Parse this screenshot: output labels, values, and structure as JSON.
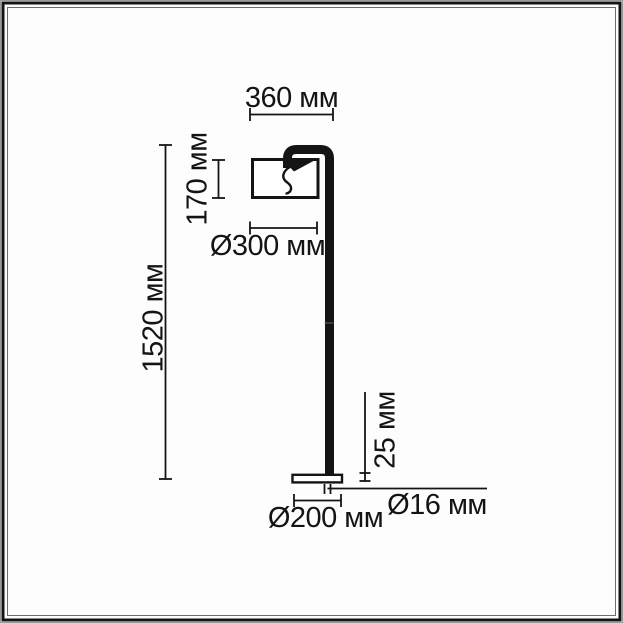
{
  "diagram": {
    "type": "technical-dimension-drawing",
    "subject": "floor-lamp",
    "units": "мм",
    "dimensions": {
      "arm_reach": {
        "label": "360 мм",
        "value": 360,
        "orientation": "horizontal"
      },
      "shade_height": {
        "label": "170 мм",
        "value": 170,
        "orientation": "vertical"
      },
      "shade_diameter": {
        "label": "Ø300 мм",
        "value": 300,
        "orientation": "horizontal"
      },
      "total_height": {
        "label": "1520 мм",
        "value": 1520,
        "orientation": "vertical"
      },
      "base_thickness": {
        "label": "25 мм",
        "value": 25,
        "orientation": "vertical"
      },
      "pole_diameter": {
        "label": "Ø16 мм",
        "value": 16,
        "orientation": "horizontal"
      },
      "base_diameter": {
        "label": "Ø200 мм",
        "value": 200,
        "orientation": "horizontal"
      }
    },
    "colors": {
      "line": "#141414",
      "background": "#ffffff",
      "outer_frame": "#141414",
      "inner_frame_line": "#6e6e6e"
    }
  }
}
